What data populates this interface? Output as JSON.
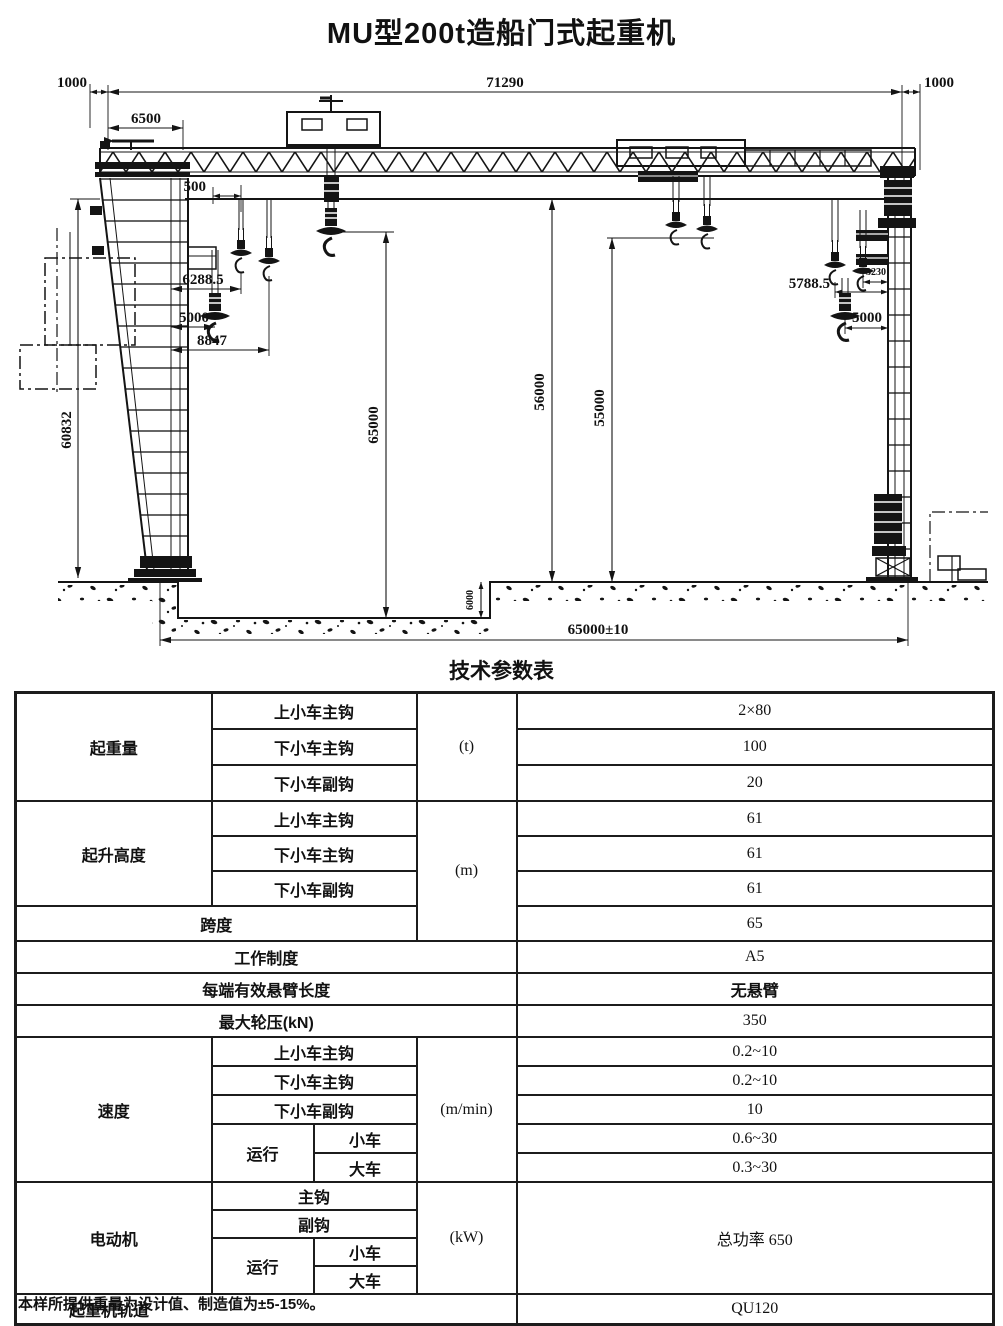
{
  "title": "MU型200t造船门式起重机",
  "drawing": {
    "dims": {
      "h71290": "71290",
      "left1000": "1000",
      "right1000": "1000",
      "h6500": "6500",
      "h500": "500",
      "h6288_5": "6288.5",
      "left5000": "5000",
      "h8847": "8847",
      "h5788_5": "5788.5",
      "h3230": "3230",
      "right5000": "5000",
      "v60832": "60832",
      "v65000": "65000",
      "v56000": "56000",
      "v55000": "55000",
      "v6000": "6000",
      "span65000": "65000±10"
    }
  },
  "table": {
    "title": "技术参数表",
    "capacity": {
      "label": "起重量",
      "unit": "(t)",
      "rows": [
        {
          "sub": "上小车主钩",
          "value": "2×80"
        },
        {
          "sub": "下小车主钩",
          "value": "100"
        },
        {
          "sub": "下小车副钩",
          "value": "20"
        }
      ]
    },
    "height": {
      "label": "起升高度",
      "unit": "(m)",
      "rows": [
        {
          "sub": "上小车主钩",
          "value": "61"
        },
        {
          "sub": "下小车主钩",
          "value": "61"
        },
        {
          "sub": "下小车副钩",
          "value": "61"
        }
      ]
    },
    "span": {
      "label": "跨度",
      "value": "65"
    },
    "duty": {
      "label": "工作制度",
      "value": "A5"
    },
    "cantilever": {
      "label": "每端有效悬臂长度",
      "value": "无悬臂"
    },
    "wheel_load": {
      "label": "最大轮压(kN)",
      "value": "350"
    },
    "speed": {
      "label": "速度",
      "unit": "(m/min)",
      "rows": [
        {
          "sub": "上小车主钩",
          "value": "0.2~10"
        },
        {
          "sub": "下小车主钩",
          "value": "0.2~10"
        },
        {
          "sub": "下小车副钩",
          "value": "10"
        }
      ],
      "travel": {
        "label": "运行",
        "rows": [
          {
            "sub": "小车",
            "value": "0.6~30"
          },
          {
            "sub": "大车",
            "value": "0.3~30"
          }
        ]
      }
    },
    "motor": {
      "label": "电动机",
      "unit": "(kW)",
      "value": "总功率 650",
      "rows": [
        {
          "sub": "主钩"
        },
        {
          "sub": "副钩"
        }
      ],
      "travel": {
        "label": "运行",
        "rows": [
          {
            "sub": "小车"
          },
          {
            "sub": "大车"
          }
        ]
      }
    },
    "rail": {
      "label": "起重机轨道",
      "value": "QU120"
    }
  },
  "footnote": "本样所提供重量为设计值、制造值为±5-15%。"
}
